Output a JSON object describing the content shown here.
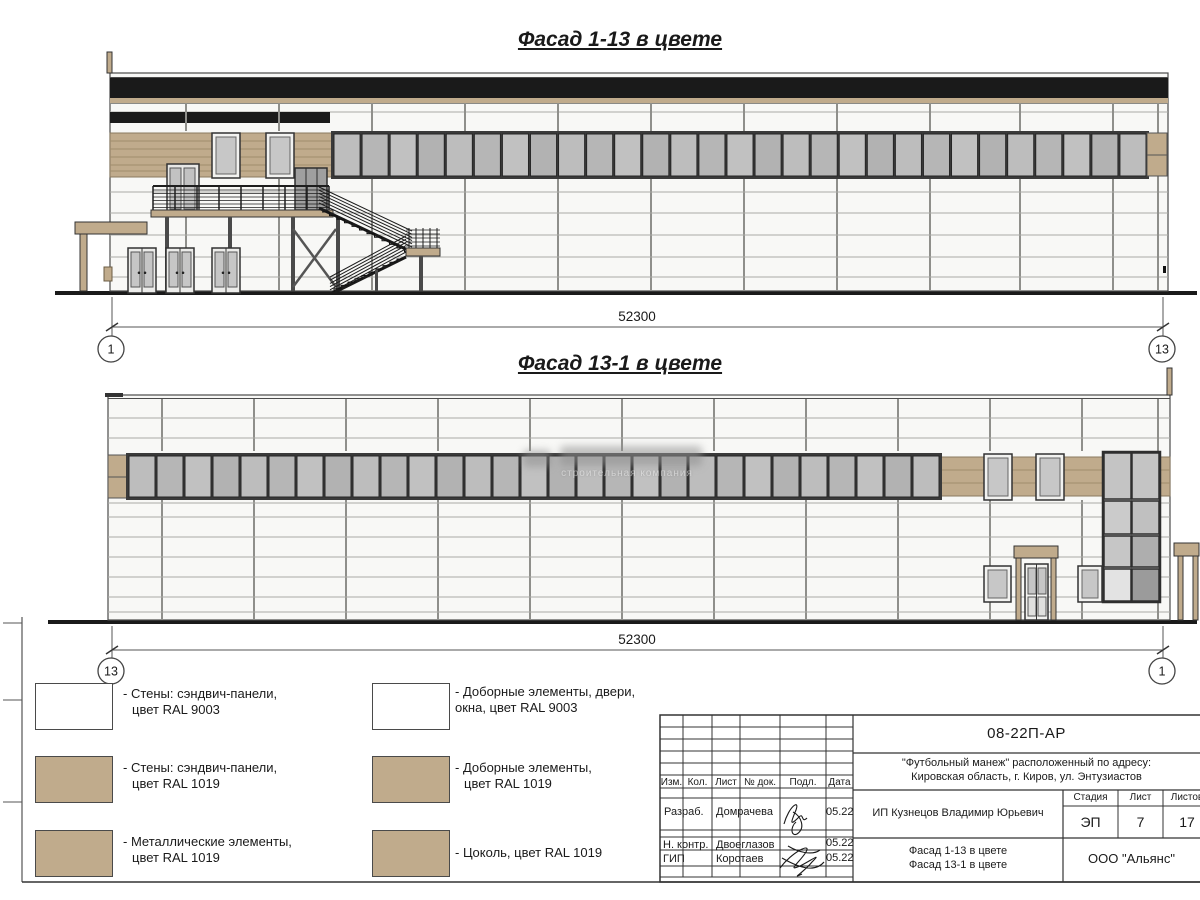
{
  "sheet": {
    "facade1_title": "Фасад 1-13 в цвете",
    "facade2_title": "Фасад 13-1 в цвете"
  },
  "dimensions": {
    "facade1": {
      "length": "52300",
      "axis_left": "1",
      "axis_right": "13"
    },
    "facade2": {
      "length": "52300",
      "axis_left": "13",
      "axis_right": "1"
    }
  },
  "legend": {
    "items": [
      {
        "color": "#ffffff",
        "line1": "- Стены: сэндвич-панели,",
        "line2": "цвет RAL 9003",
        "indent": true
      },
      {
        "color": "#c0ab8c",
        "line1": "- Стены: сэндвич-панели,",
        "line2": "цвет RAL 1019",
        "indent": true
      },
      {
        "color": "#c0ab8c",
        "line1": "- Металлические элементы,",
        "line2": "цвет RAL 1019",
        "indent": true
      },
      {
        "color": "#ffffff",
        "line1": "- Доборные элементы, двери,",
        "line2": "окна, цвет RAL 9003",
        "indent": false
      },
      {
        "color": "#c0ab8c",
        "line1": "- Доборные элементы,",
        "line2": "цвет RAL 1019",
        "indent": true
      },
      {
        "color": "#c0ab8c",
        "line1": "- Цоколь, цвет RAL 1019",
        "line2": "",
        "indent": false
      }
    ]
  },
  "watermark": {
    "subtitle": "строительная компания"
  },
  "title_block": {
    "doc_number": "08-22П-АР",
    "object_line1": "\"Футбольный манеж\" расположенный по адресу:",
    "object_line2": "Кировская область, г. Киров, ул. Энтузиастов",
    "client": "ИП Кузнецов Владимир Юрьевич",
    "col_izm": "Изм.",
    "col_kol": "Кол.",
    "col_list": "Лист",
    "col_ndok": "№ док.",
    "col_podp": "Подл.",
    "col_data": "Дата",
    "row1_role": "Разраб.",
    "row1_name": "Домрачева",
    "row1_date": "05.22",
    "row2_role": "Н. контр.",
    "row2_name": "Двоеглазов",
    "row2_date": "05.22",
    "row3_role": "ГИП",
    "row3_name": "Коротаев",
    "row3_date": "05.22",
    "stage_label": "Стадия",
    "list_label": "Лист",
    "listov_label": "Листов",
    "stage": "ЭП",
    "list": "7",
    "listov": "17",
    "title_line1": "Фасад 1-13 в цвете",
    "title_line2": "Фасад 13-1 в цвете",
    "company": "ООО \"Альянс\""
  },
  "colors": {
    "tan": "#c0ab8c",
    "tan_line": "#a08c6c",
    "black_band": "#1a1a1a",
    "glass": "#b9b9b9",
    "window_frame": "#3a3a3a",
    "wall": "#f8f8f6",
    "panel_line": "#aaaaa6",
    "joint_line": "#8f8f8b",
    "outline": "#4a4a4a"
  }
}
